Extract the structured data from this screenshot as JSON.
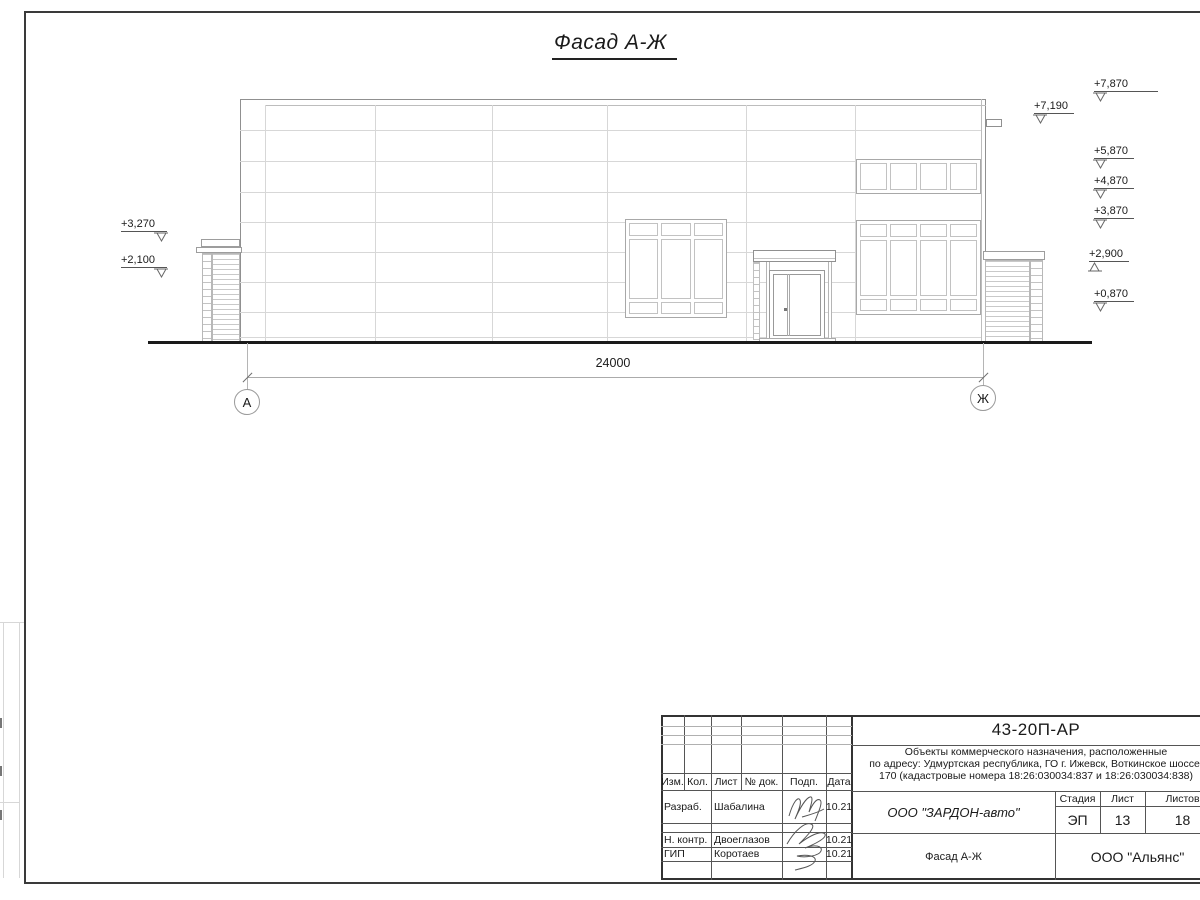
{
  "drawing": {
    "title": "Фасад А-Ж",
    "dimension": "24000",
    "axis_left": "А",
    "axis_right": "Ж",
    "marks_right": [
      "+7,870",
      "+7,190",
      "+5,870",
      "+4,870",
      "+3,870",
      "+2,900",
      "+0,870"
    ],
    "marks_left": [
      "+3,270",
      "+2,100"
    ]
  },
  "title_block": {
    "doc_number": "43-20П-АР",
    "project_desc_line1": "Объекты коммерческого назначения, расположенные",
    "project_desc_line2": "по адресу: Удмуртская республика, ГО г. Ижевск, Воткинское шоссе,",
    "project_desc_line3": "170 (кадастровые номера 18:26:030034:837 и 18:26:030034:838)",
    "col_izm": "Изм.",
    "col_kol": "Кол.",
    "col_list": "Лист",
    "col_doc": "№ док.",
    "col_podp": "Подп.",
    "col_data": "Дата",
    "row_developer_role": "Разраб.",
    "row_developer_name": "Шабалина",
    "row_developer_date": "10.21",
    "row_ncontr_role": "Н. контр.",
    "row_ncontr_name": "Двоеглазов",
    "row_ncontr_date": "10.21",
    "row_gip_role": "ГИП",
    "row_gip_name": "Коротаев",
    "row_gip_date": "10.21",
    "company": "ООО \"ЗАРДОН-авто\"",
    "stage_label": "Стадия",
    "sheet_label": "Лист",
    "sheets_label": "Листов",
    "stage_value": "ЭП",
    "sheet_value": "13",
    "sheets_value": "18",
    "drawing_name": "Фасад А-Ж",
    "contractor": "ООО \"Альянс\""
  },
  "colors": {
    "paper": "#ffffff",
    "line_dark": "#333333",
    "line_medium": "#9a9a9a",
    "line_light": "#d7d7d7"
  }
}
